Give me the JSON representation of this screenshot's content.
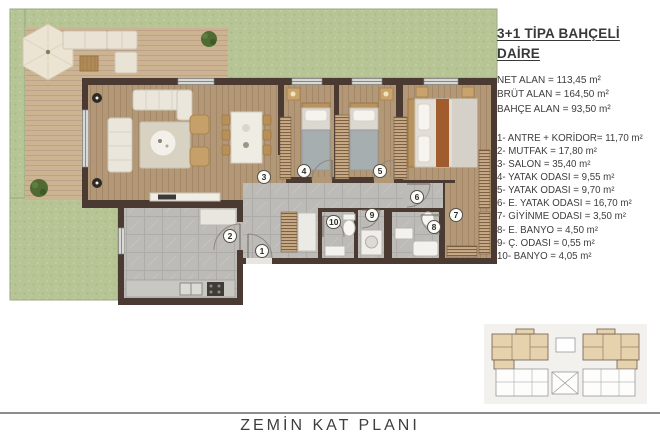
{
  "panel": {
    "title_line1": "3+1 TİPA BAHÇELİ",
    "title_line2": "DAİRE",
    "stats": [
      "NET ALAN = 113,45 m²",
      "BRÜT ALAN = 164,50 m²",
      "BAHÇE ALAN = 93,50 m²"
    ],
    "rooms": [
      "1- ANTRE + KORİDOR= 11,70 m²",
      "2- MUTFAK = 17,80 m²",
      "3- SALON = 35,40 m²",
      "4- YATAK ODASI = 9,55 m²",
      "5- YATAK ODASI = 9,70 m²",
      "6- E. YATAK ODASI = 16,70 m²",
      "7- GİYİNME ODASI = 3,50 m²",
      "8- E. BANYO = 4,50 m²",
      "9- Ç. ODASI = 0,55 m²",
      "10- BANYO = 4,05 m²"
    ]
  },
  "plan": {
    "badge_numbers": [
      "1",
      "2",
      "3",
      "4",
      "5",
      "6",
      "7",
      "8",
      "9",
      "10"
    ]
  },
  "footer": {
    "caption": "ZEMİN KAT PLANI"
  },
  "colors": {
    "garden": "#b7c596",
    "deck": "#ccb493",
    "wall": "#4a3a31",
    "wood_floor": "#b39877",
    "tile_floor": "#bdbbb7",
    "highlight_unit": "#e7d2ae"
  }
}
